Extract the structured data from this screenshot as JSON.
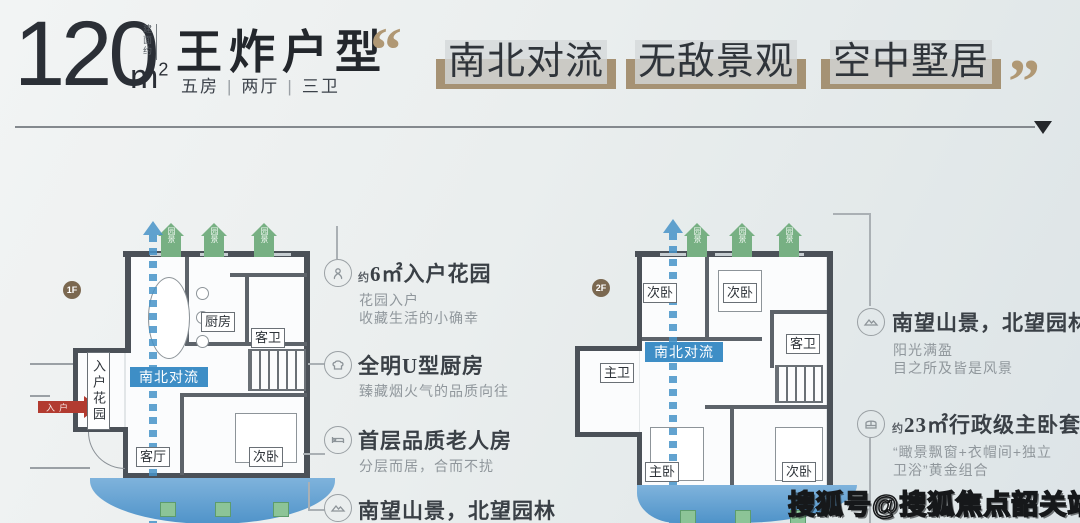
{
  "header": {
    "area_value": "120",
    "area_unit_base": "m",
    "area_unit_sup": "2",
    "area_note": "建面约",
    "title": "王炸户型",
    "specs": [
      "五房",
      "两厅",
      "三卫"
    ],
    "spec_separator": "|"
  },
  "slogan": {
    "open_quote": "“",
    "close_quote": "”",
    "phrases": [
      "南北对流",
      "无敌景观",
      "空中墅居"
    ],
    "highlight_color": "#a08a69",
    "quote_color": "#b09874"
  },
  "plan1": {
    "badge": "1F",
    "arrow_label": "园景",
    "flow_label": "南北对流",
    "entry_label": "入户",
    "room_kitchen": "厨房",
    "room_guest_bath": "客卫",
    "room_entry_garden": "入户花园",
    "room_living": "客厅",
    "room_bedroom": "次卧"
  },
  "plan2": {
    "badge": "2F",
    "arrow_label": "园景",
    "flow_label": "南北对流",
    "room_bedroom_a": "次卧",
    "room_bedroom_b": "次卧",
    "room_guest_bath": "客卫",
    "room_master_bath": "主卫",
    "room_master": "主卧",
    "room_bedroom_c": "次卧"
  },
  "features_left": [
    {
      "icon": "flower-icon",
      "prefix": "约",
      "title": "6㎡入户花园",
      "lines": [
        "花园入户",
        "收藏生活的小确幸"
      ]
    },
    {
      "icon": "chef-hat-icon",
      "prefix": "",
      "title": "全明U型厨房",
      "lines": [
        "臻藏烟火气的品质向往"
      ]
    },
    {
      "icon": "bed-icon",
      "prefix": "",
      "title": "首层品质老人房",
      "lines": [
        "分层而居，合而不扰"
      ]
    },
    {
      "icon": "mountain-icon",
      "prefix": "",
      "title": "南望山景，北望园林",
      "lines": []
    }
  ],
  "features_right": [
    {
      "icon": "mountain-icon",
      "prefix": "",
      "title": "南望山景，北望园林",
      "lines": [
        "阳光满盈",
        "目之所及皆是风景"
      ]
    },
    {
      "icon": "bay-window-icon",
      "prefix": "约",
      "title": "23㎡行政级主卧套房",
      "lines": [
        "“瞰景飘窗+衣帽间+独立",
        "卫浴”黄金组合"
      ]
    }
  ],
  "colors": {
    "flow_blue": "#3e8ec6",
    "garden_green": "#77b083",
    "entry_red": "#b23b30",
    "badge_bronze": "#7b6850",
    "water_blue": "#4f93c9"
  },
  "watermark": "搜狐号@搜狐焦点韶关站"
}
